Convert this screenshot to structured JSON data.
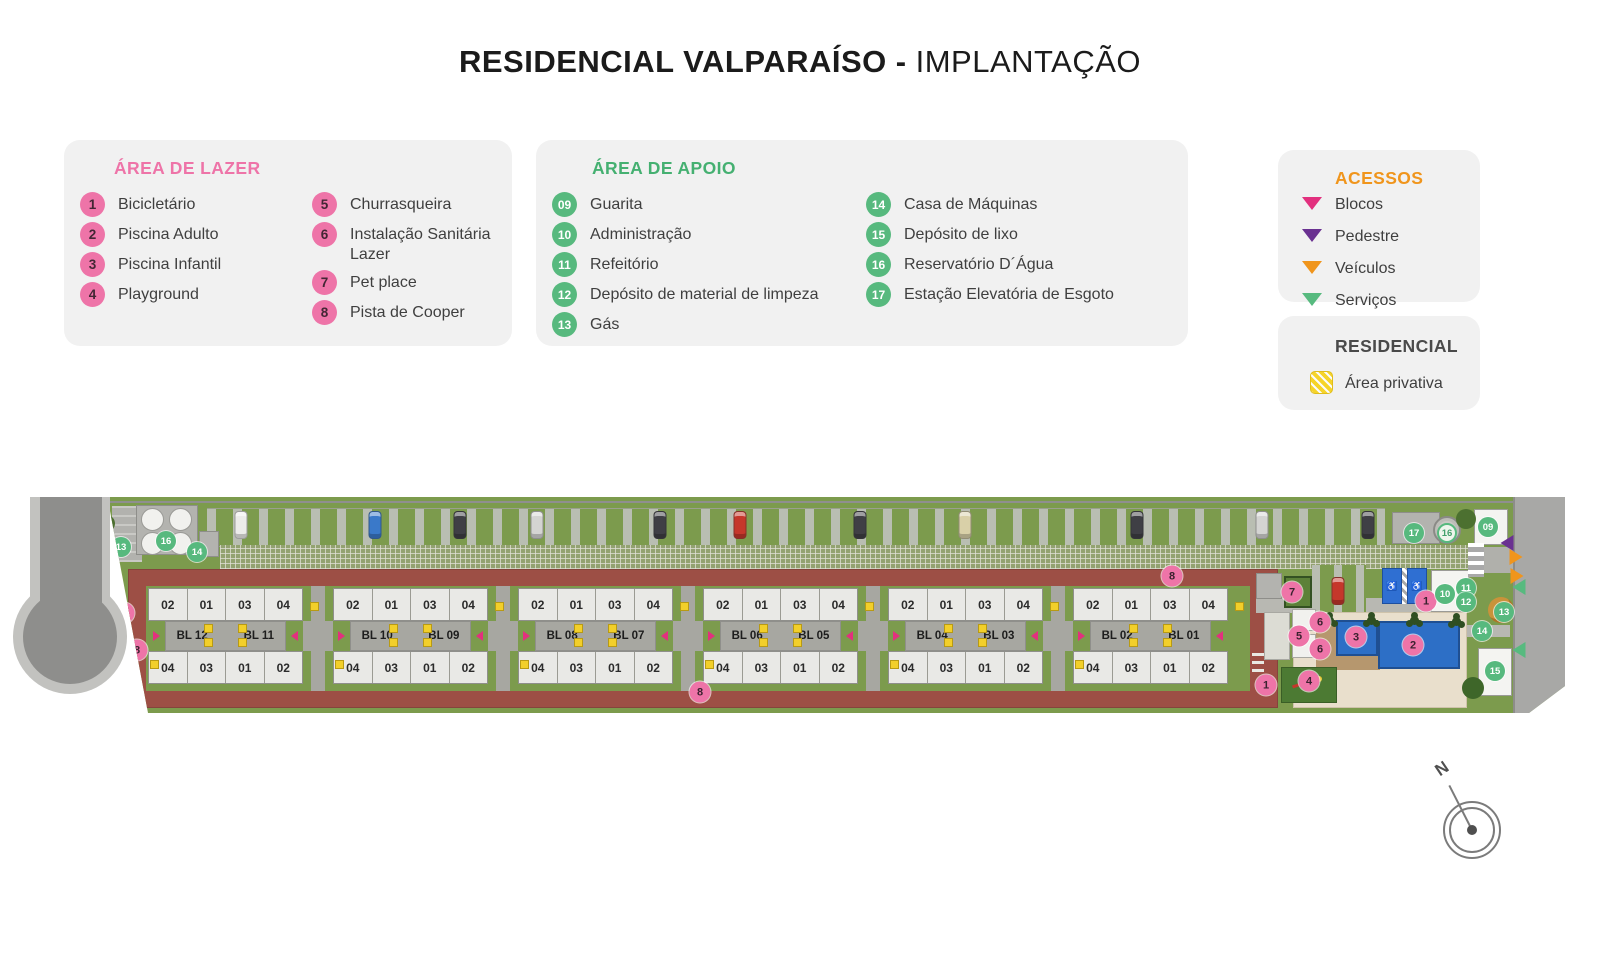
{
  "title": {
    "main": "RESIDENCIAL VALPARAÍSO",
    "sep": "-",
    "sub": "IMPLANTAÇÃO"
  },
  "legend_lazer": {
    "title": "ÁREA DE LAZER",
    "col1": [
      {
        "n": "1",
        "label": "Bicicletário"
      },
      {
        "n": "2",
        "label": "Piscina Adulto"
      },
      {
        "n": "3",
        "label": "Piscina Infantil"
      },
      {
        "n": "4",
        "label": "Playground"
      }
    ],
    "col2": [
      {
        "n": "5",
        "label": "Churrasqueira"
      },
      {
        "n": "6",
        "label": "Instalação Sanitária Lazer"
      },
      {
        "n": "7",
        "label": "Pet place"
      },
      {
        "n": "8",
        "label": "Pista de Cooper"
      }
    ]
  },
  "legend_apoio": {
    "title": "ÁREA DE APOIO",
    "col1": [
      {
        "n": "09",
        "label": "Guarita"
      },
      {
        "n": "10",
        "label": "Administração"
      },
      {
        "n": "11",
        "label": "Refeitório"
      },
      {
        "n": "12",
        "label": "Depósito de material de limpeza"
      },
      {
        "n": "13",
        "label": "Gás"
      }
    ],
    "col2": [
      {
        "n": "14",
        "label": "Casa de Máquinas"
      },
      {
        "n": "15",
        "label": "Depósito de lixo"
      },
      {
        "n": "16",
        "label": "Reservatório D´Água"
      },
      {
        "n": "17",
        "label": "Estação Elevatória de Esgoto"
      }
    ]
  },
  "acessos": {
    "title": "ACESSOS",
    "items": [
      {
        "label": "Blocos",
        "color": "#e2307e"
      },
      {
        "label": "Pedestre",
        "color": "#6a3191"
      },
      {
        "label": "Veículos",
        "color": "#f0951c"
      },
      {
        "label": "Serviços",
        "color": "#57ba7f"
      }
    ]
  },
  "residencial": {
    "title": "RESIDENCIAL",
    "item": "Área privativa",
    "swatch_color": "#f6d42a"
  },
  "colors": {
    "pink": "#ee74a8",
    "green": "#57b97e",
    "track": "#9d4f45",
    "grass": "#7c9b4d",
    "private_yellow": "#f2cf2a"
  },
  "plan": {
    "unit_top": [
      "02",
      "01",
      "03",
      "04"
    ],
    "unit_bottom": [
      "04",
      "03",
      "01",
      "02"
    ],
    "block_pairs": [
      [
        "BL 12",
        "BL 11"
      ],
      [
        "BL 10",
        "BL 09"
      ],
      [
        "BL 08",
        "BL 07"
      ],
      [
        "BL 06",
        "BL 05"
      ],
      [
        "BL 04",
        "BL 03"
      ],
      [
        "BL 02",
        "BL 01"
      ]
    ],
    "markers": [
      {
        "n": "13",
        "t": "green",
        "x": 121,
        "y": 50
      },
      {
        "n": "16",
        "t": "green",
        "x": 166,
        "y": 44
      },
      {
        "n": "14",
        "t": "green",
        "x": 197,
        "y": 55
      },
      {
        "n": "1",
        "t": "pink",
        "x": 124,
        "y": 116
      },
      {
        "n": "8",
        "t": "pink",
        "x": 137,
        "y": 153
      },
      {
        "n": "8",
        "t": "pink",
        "x": 700,
        "y": 195
      },
      {
        "n": "8",
        "t": "pink",
        "x": 1172,
        "y": 79
      },
      {
        "n": "7",
        "t": "pink",
        "x": 1292,
        "y": 95
      },
      {
        "n": "1",
        "t": "pink",
        "x": 1426,
        "y": 104
      },
      {
        "n": "5",
        "t": "pink",
        "x": 1299,
        "y": 139
      },
      {
        "n": "6",
        "t": "pink",
        "x": 1320,
        "y": 125
      },
      {
        "n": "6",
        "t": "pink",
        "x": 1320,
        "y": 152
      },
      {
        "n": "3",
        "t": "pink",
        "x": 1356,
        "y": 140
      },
      {
        "n": "2",
        "t": "pink",
        "x": 1413,
        "y": 148
      },
      {
        "n": "4",
        "t": "pink",
        "x": 1309,
        "y": 184
      },
      {
        "n": "1",
        "t": "pink",
        "x": 1266,
        "y": 188
      },
      {
        "n": "17",
        "t": "green",
        "x": 1414,
        "y": 36
      },
      {
        "n": "16",
        "t": "ring",
        "x": 1447,
        "y": 36
      },
      {
        "n": "09",
        "t": "green",
        "x": 1488,
        "y": 30
      },
      {
        "n": "10",
        "t": "green",
        "x": 1445,
        "y": 97
      },
      {
        "n": "11",
        "t": "green",
        "x": 1466,
        "y": 91
      },
      {
        "n": "12",
        "t": "green",
        "x": 1466,
        "y": 105
      },
      {
        "n": "13",
        "t": "green",
        "x": 1504,
        "y": 115
      },
      {
        "n": "14",
        "t": "green",
        "x": 1482,
        "y": 134
      },
      {
        "n": "15",
        "t": "green",
        "x": 1495,
        "y": 174
      }
    ],
    "cars": [
      {
        "x": 241,
        "color": "#ececea"
      },
      {
        "x": 375,
        "color": "#3a79c9"
      },
      {
        "x": 460,
        "color": "#3f3f45"
      },
      {
        "x": 537,
        "color": "#d4d4d2"
      },
      {
        "x": 660,
        "color": "#3f3f45"
      },
      {
        "x": 740,
        "color": "#c5372b"
      },
      {
        "x": 860,
        "color": "#3f3f45"
      },
      {
        "x": 965,
        "color": "#d9d0a8"
      },
      {
        "x": 1137,
        "color": "#3f3f45"
      },
      {
        "x": 1262,
        "color": "#d4d4d2"
      },
      {
        "x": 1368,
        "color": "#3f3f45"
      },
      {
        "x": 1338,
        "y": 80,
        "color": "#c5372b"
      }
    ],
    "access_triangles": [
      {
        "dir": "right",
        "color": "#57ba7f",
        "x": 112,
        "y": 74
      },
      {
        "dir": "left",
        "color": "#6a3191",
        "x": 1507,
        "y": 46
      },
      {
        "dir": "right",
        "color": "#f0951c",
        "x": 1516,
        "y": 60
      },
      {
        "dir": "right",
        "color": "#f0951c",
        "x": 1517,
        "y": 79
      },
      {
        "dir": "left",
        "color": "#57ba7f",
        "x": 1519,
        "y": 90
      },
      {
        "dir": "left",
        "color": "#57ba7f",
        "x": 1519,
        "y": 153
      }
    ]
  },
  "compass": {
    "label": "N"
  }
}
